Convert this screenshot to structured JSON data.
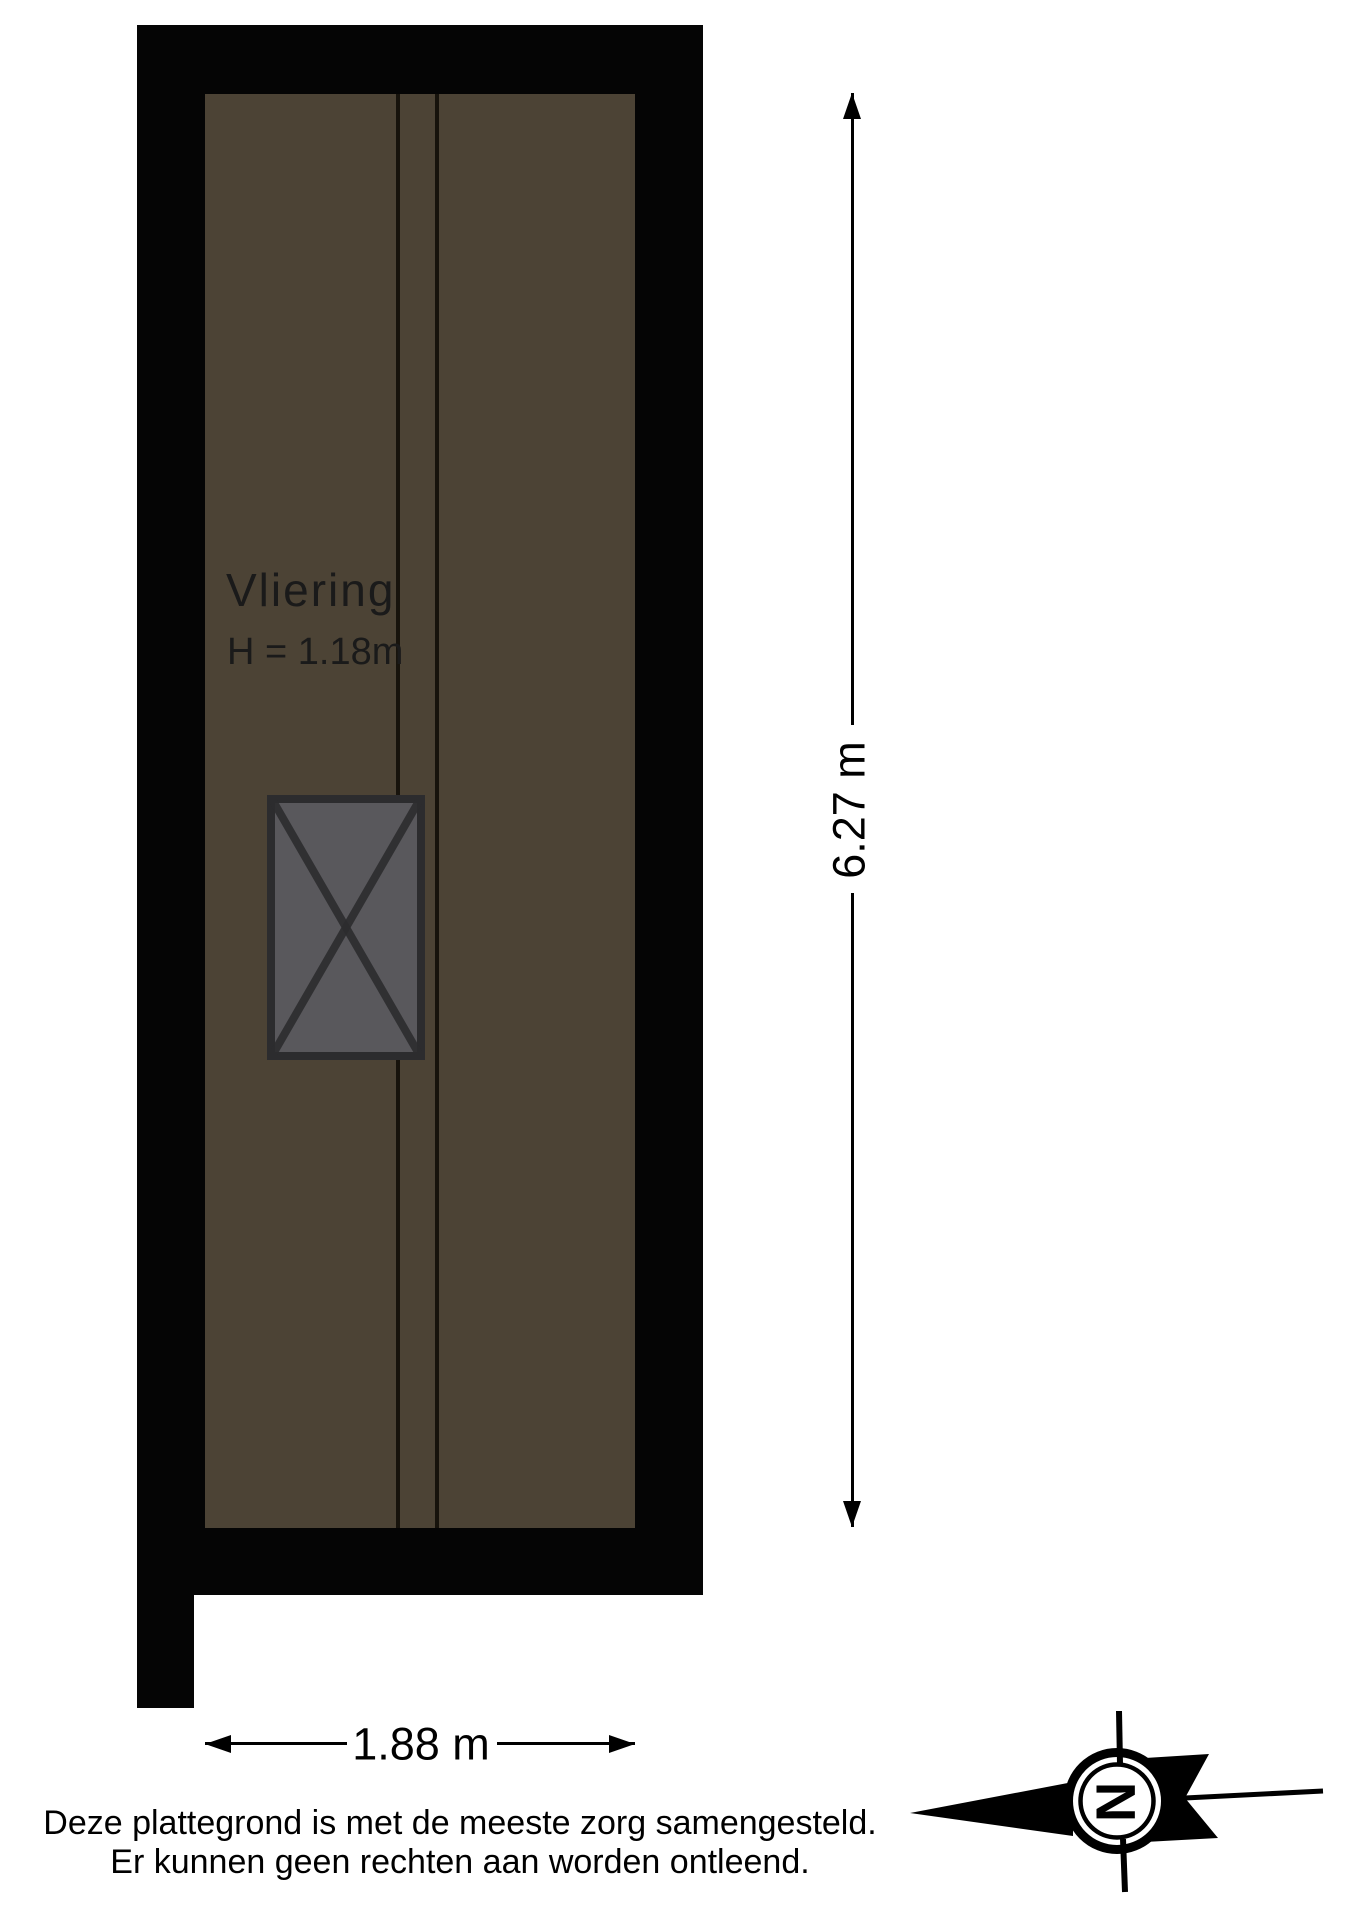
{
  "colors": {
    "wall-black": "#050505",
    "floor-brown": "#4c4335",
    "hatch-fill": "#59585c",
    "hatch-stroke": "#2c2c2e",
    "beam-line": "#17130c",
    "label-ink": "#1a1a1a",
    "ink": "#000000"
  },
  "plan": {
    "room_label": "Vliering",
    "height_label": "H = 1.18m"
  },
  "dimensions": {
    "vertical_label": "6.27 m",
    "horizontal_label": "1.88 m"
  },
  "disclaimer": {
    "line1": "Deze plattegrond is met de meeste zorg samengesteld.",
    "line2": "Er kunnen geen rechten aan worden ontleend."
  },
  "compass": {
    "north_label": "N"
  }
}
